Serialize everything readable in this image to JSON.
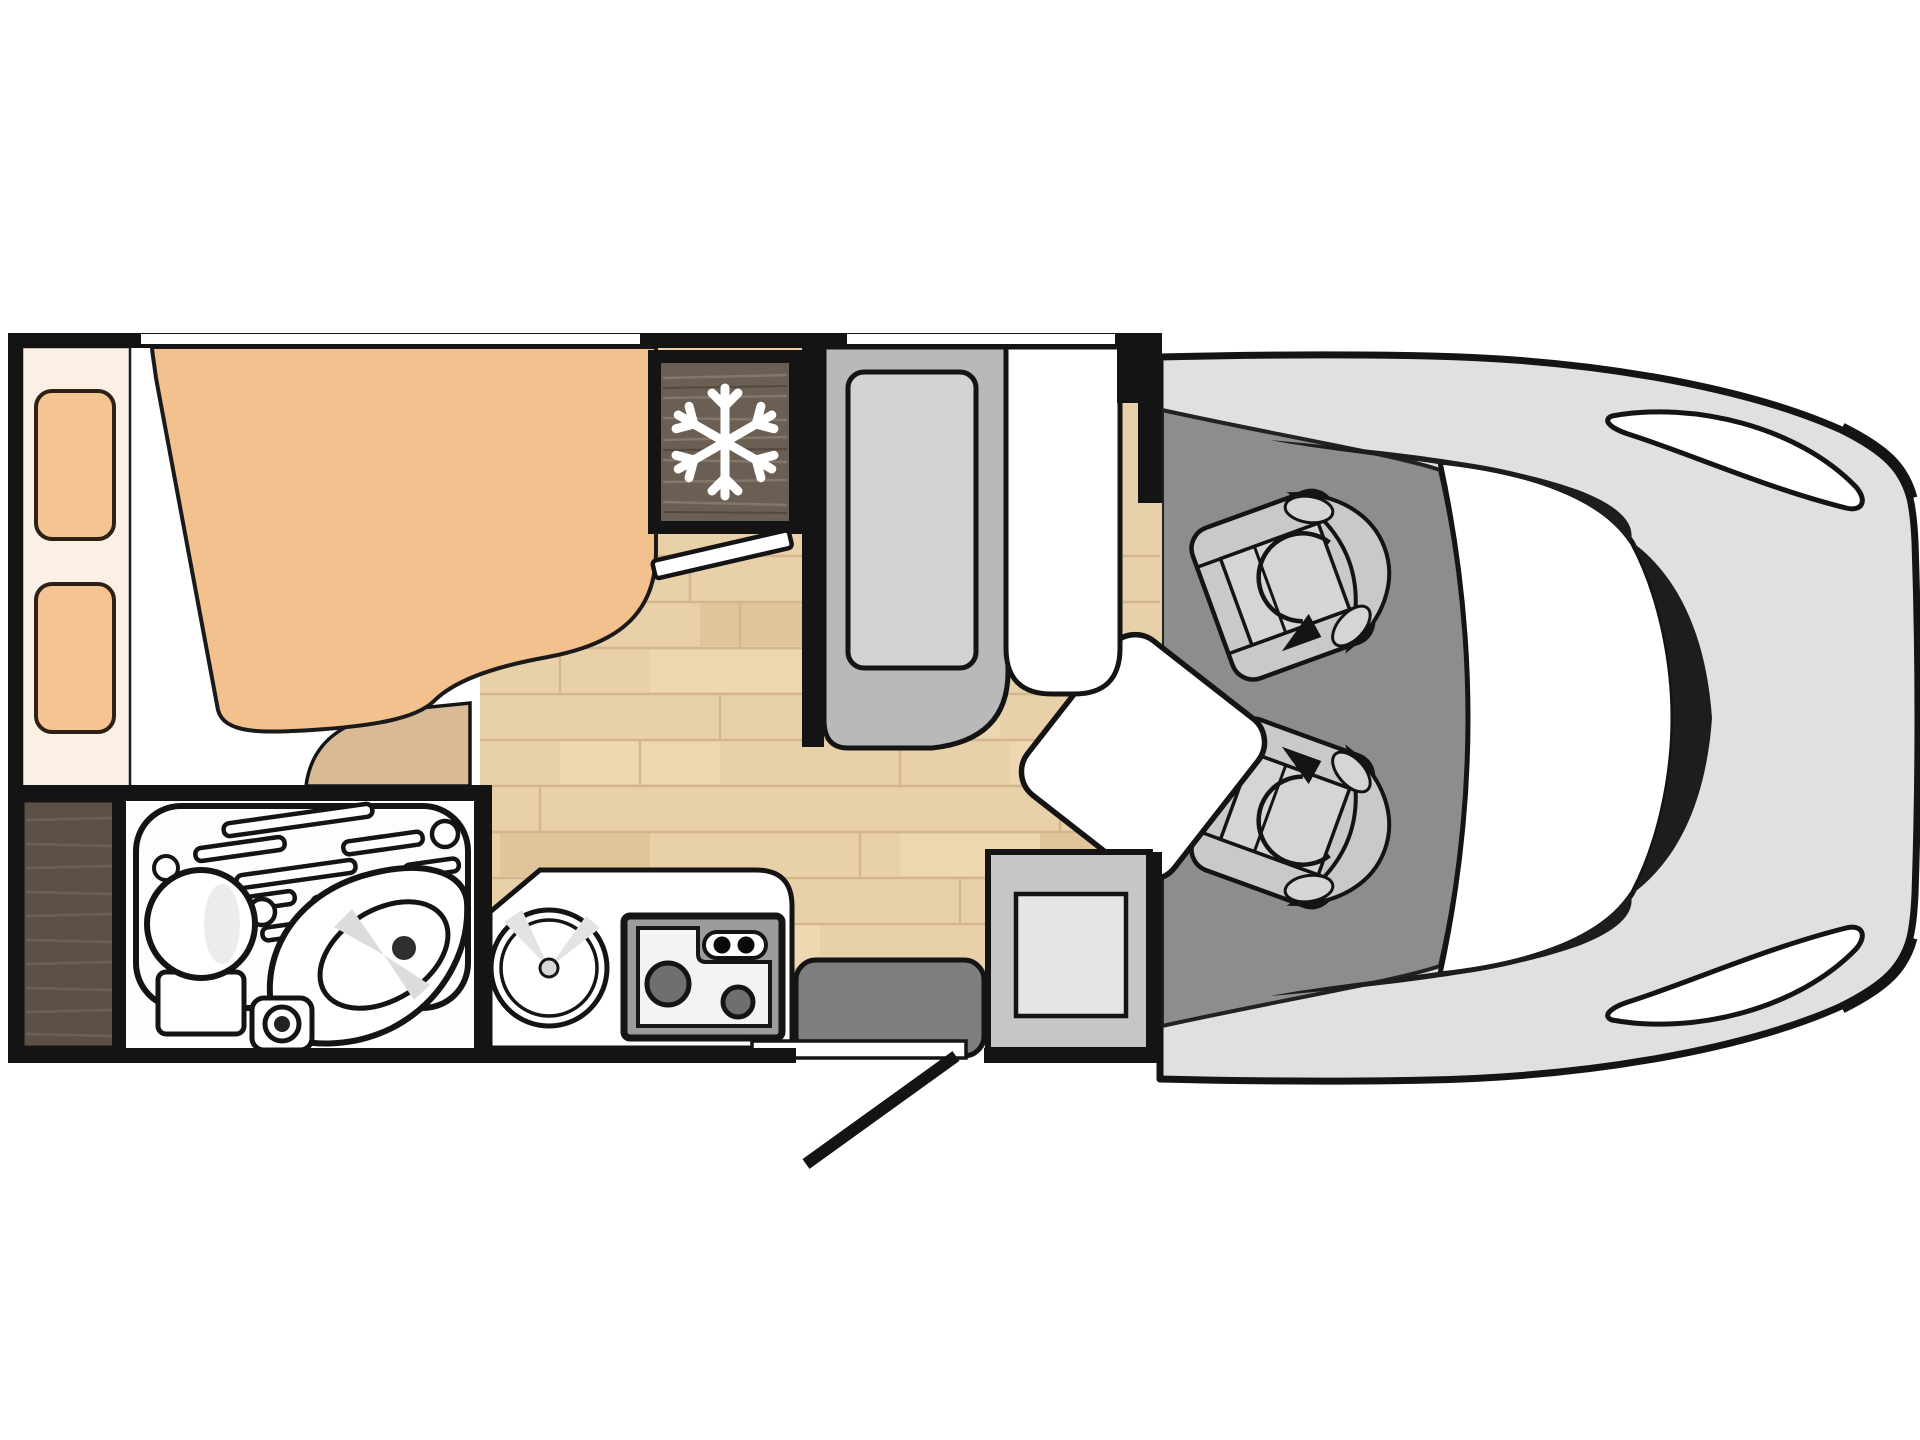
{
  "floorplan": {
    "type": "motorhome-floorplan",
    "view": "top-down",
    "zones": [
      {
        "name": "rear-bedroom",
        "items": [
          "french-bed-mattress",
          "headboard-shelf",
          "pillow",
          "pillow",
          "bed-step"
        ]
      },
      {
        "name": "washroom",
        "items": [
          "shower-tray",
          "toilet",
          "corner-washbasin",
          "faucet-unit"
        ]
      },
      {
        "name": "wardrobe",
        "items": [
          "wardrobe-cabinet"
        ]
      },
      {
        "name": "refrigerator",
        "items": [
          "fridge-with-snowflake-icon"
        ]
      },
      {
        "name": "kitchen",
        "items": [
          "kitchen-counter",
          "round-sink",
          "two-burner-hob",
          "hob-control-knobs"
        ]
      },
      {
        "name": "dinette",
        "items": [
          "bench-seat",
          "backrest-cushion",
          "white-seat-cushion",
          "pedestal-table"
        ]
      },
      {
        "name": "entrance",
        "items": [
          "entry-step",
          "entry-door-swing",
          "threshold"
        ]
      },
      {
        "name": "cab",
        "items": [
          "driver-swivel-seat",
          "passenger-swivel-seat",
          "windshield",
          "headlight",
          "headlight",
          "vehicle-body"
        ]
      }
    ],
    "icons": {
      "snowflake": "refrigerator-freezer",
      "rotation_arrow": "swivelling cab seat"
    }
  },
  "colors": {
    "wall": "#141414",
    "background": "#ffffff",
    "headboard": "#faf1e4",
    "pillow": "#f5c493",
    "mattress": "#f3c18e",
    "bed_step": "#d9ba94",
    "bed_base": "#ffffff",
    "floor": "#e8d0a9",
    "fridge_wood": "#6b5e53",
    "wardrobe_wood": "#5d5146",
    "snowflake": "#ffffff",
    "bench": "#b9b9b9",
    "bench_cushion": "#d3d3d3",
    "seat_cushion_white": "#ffffff",
    "bath_white": "#fefefe",
    "cab_floor": "#8d8d8d",
    "vehicle_body": "#e0e0e0",
    "windshield": "#ffffff",
    "pillar": "#1d1d1d",
    "seat_base": "#c9c9c9",
    "seat_pad": "#d5d5d5",
    "table": "#ffffff",
    "cabinet": "#c6c6c6",
    "cabinet_inner": "#e5e5e5",
    "step": "#7e7e7e",
    "counter": "#ffffff",
    "stove_frame": "#9c9c9c",
    "cooktop": "#f3f3f3",
    "burner": "#6f6f6f",
    "drain": "#2f2f2f"
  }
}
